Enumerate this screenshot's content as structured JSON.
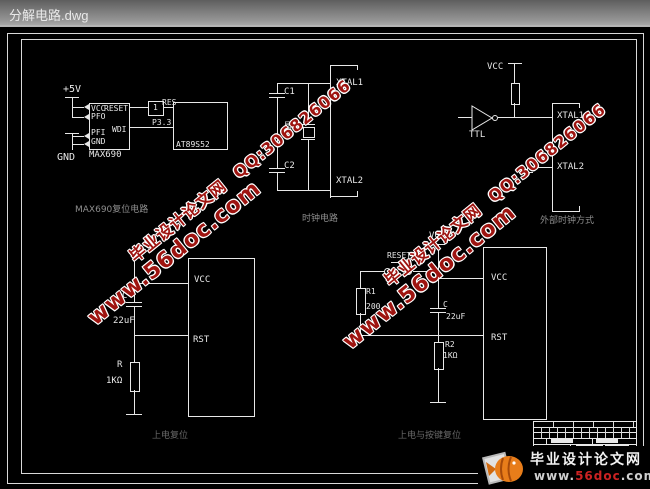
{
  "window": {
    "title": "分解电路.dwg"
  },
  "colors": {
    "wire": "#e8e8e8",
    "watermark_red": "#9e1410",
    "logo_red": "#cc2222"
  },
  "watermark": {
    "site": "毕业设计论文网",
    "qq": "QQ:306826066",
    "url": "www.56doc.com"
  },
  "logo": {
    "site": "毕业设计论文网",
    "url_www": "www.",
    "url_name": "56doc",
    "url_tld": ".com"
  },
  "sections": {
    "max690": {
      "title": "MAX690复位电路",
      "plus5v": "+5V",
      "pin_vcc": "VCC",
      "pin_reset": "RESET",
      "pin_pfo": "PFO",
      "pin_pfi": "PFI",
      "pin_gnd": "GND",
      "pin_wdi": "WDI",
      "gnd": "GND",
      "chip": "MAX690",
      "buffer": "1",
      "pin_res": "RES",
      "pin_p33": "P3.3",
      "mcu": "AT89S52"
    },
    "clock": {
      "title": "时钟电路",
      "c1": "C1",
      "c2": "C2",
      "crystal": "晶振",
      "xtal1": "XTAL1",
      "xtal2": "XTAL2"
    },
    "ext_clock": {
      "title": "外部时钟方式",
      "vcc": "VCC",
      "gate": "TTL",
      "xtal1": "XTAL1",
      "xtal2": "XTAL2"
    },
    "por": {
      "title": "上电复位",
      "c": "C",
      "c_val": "22uF",
      "r": "R",
      "r_val": "1KΩ",
      "pin_vcc": "VCC",
      "pin_rst": "RST"
    },
    "key_reset": {
      "title": "上电与按键复位",
      "rail_vcc": "VCC",
      "button": "RESET",
      "r1": "R1",
      "r1_val": "200",
      "c": "C",
      "c_val": "22uF",
      "r2": "R2",
      "r2_val": "1KΩ",
      "pin_vcc": "VCC",
      "pin_rst": "RST"
    }
  }
}
